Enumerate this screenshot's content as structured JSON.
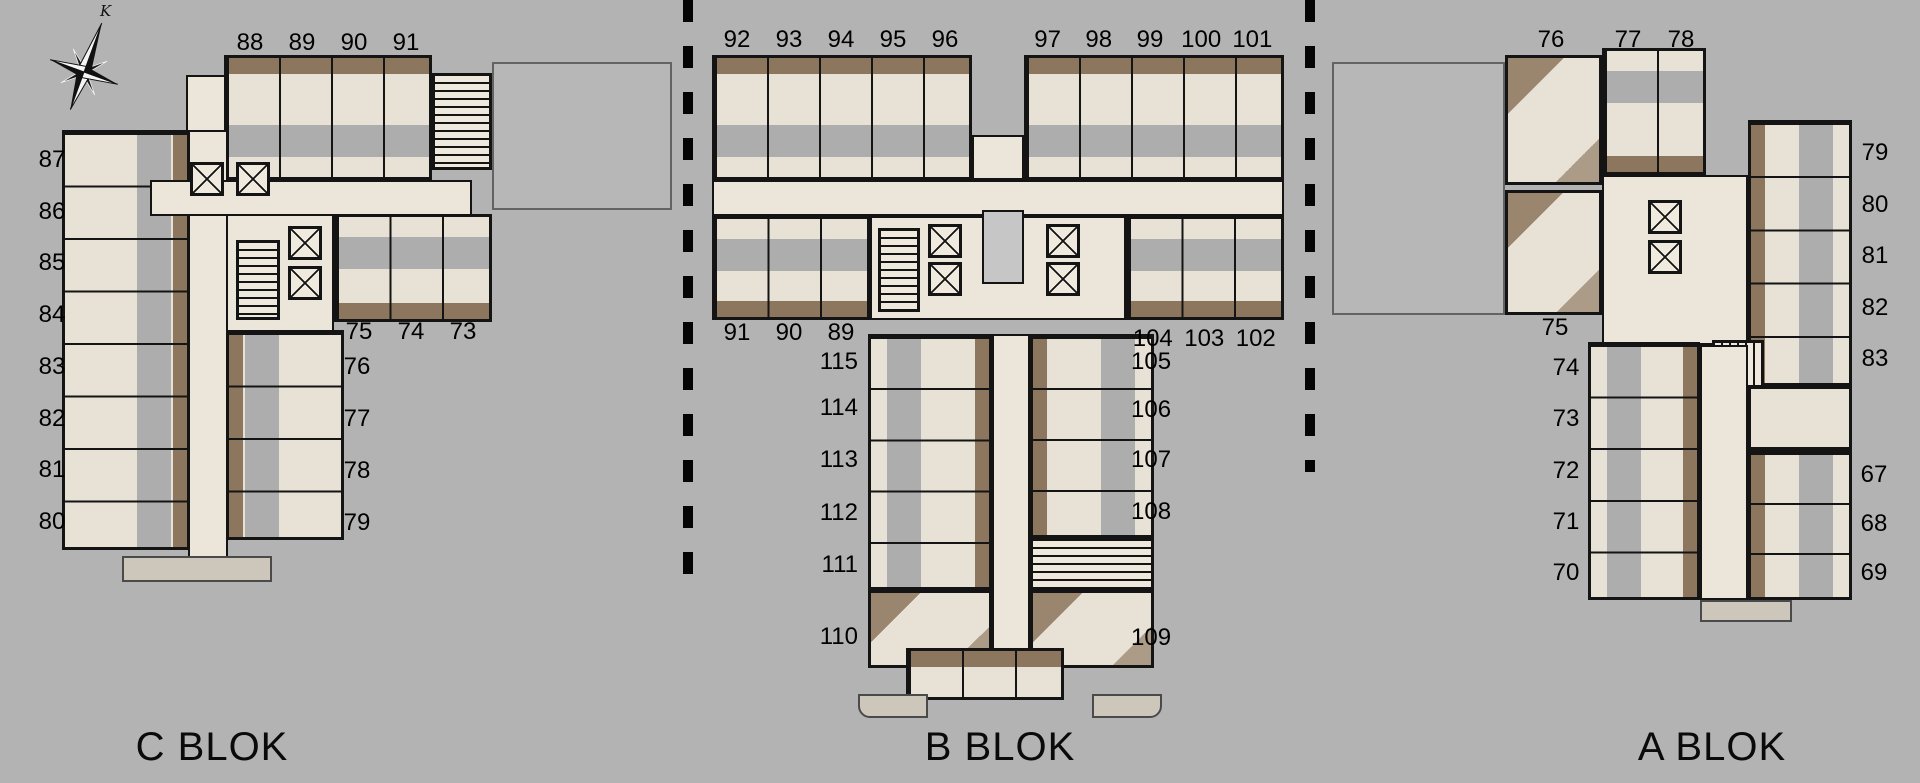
{
  "compass": {
    "north_label": "K"
  },
  "blocks": [
    {
      "name": "C BLOK",
      "rooms": {
        "top_row": [
          "88",
          "89",
          "90",
          "91"
        ],
        "left_column": [
          "87",
          "86",
          "85",
          "84",
          "83",
          "82",
          "81",
          "80"
        ],
        "inner_row": [
          "75",
          "74",
          "73"
        ],
        "right_column": [
          "76",
          "77",
          "78",
          "79"
        ]
      }
    },
    {
      "name": "B BLOK",
      "rooms": {
        "top_left_row": [
          "92",
          "93",
          "94",
          "95",
          "96"
        ],
        "top_right_row": [
          "97",
          "98",
          "99",
          "100",
          "101"
        ],
        "mid_left_row": [
          "91",
          "90",
          "89"
        ],
        "mid_right_row": [
          "104",
          "103",
          "102"
        ],
        "stem_left_column": [
          "115",
          "114",
          "113",
          "112",
          "111",
          "110"
        ],
        "stem_right_column": [
          "105",
          "106",
          "107",
          "108",
          "109"
        ]
      }
    },
    {
      "name": "A BLOK",
      "rooms": {
        "top_row": [
          "76",
          "77",
          "78"
        ],
        "right_upper_column": [
          "79",
          "80",
          "81",
          "82",
          "83"
        ],
        "left_single": [
          "75"
        ],
        "left_column": [
          "74",
          "73",
          "72",
          "71",
          "70"
        ],
        "right_lower_column": [
          "67",
          "68",
          "69"
        ]
      }
    }
  ],
  "colors": {
    "background": "#b3b3b3",
    "walls": "#141414",
    "floor_marble": "#e8e1d5",
    "wood": "#8c765d",
    "void_gray": "#c6c6c6",
    "number_text": "#000000"
  }
}
